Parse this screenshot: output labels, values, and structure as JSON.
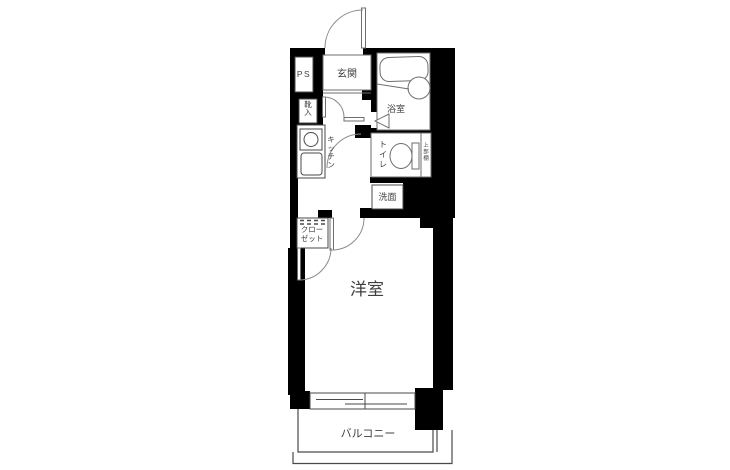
{
  "plan": {
    "type": "floor-plan",
    "rooms": {
      "pipe_space": "PS",
      "entrance": "玄関",
      "bathroom": "浴室",
      "shoe_cabinet": "靴入",
      "kitchen": "キッチン",
      "toilet": "トイレ",
      "upper_shelf": "上部棚",
      "washstand": "洗面",
      "closet_line1": "クロー",
      "closet_line2": "ゼット",
      "western_room": "洋室",
      "balcony": "バルコニー"
    },
    "colors": {
      "wall": "#000000",
      "line": "#4a4a4a",
      "fixture": "#6e6e6e",
      "arc": "#8a8a8a",
      "text": "#3f3f3f",
      "background": "#ffffff"
    }
  }
}
